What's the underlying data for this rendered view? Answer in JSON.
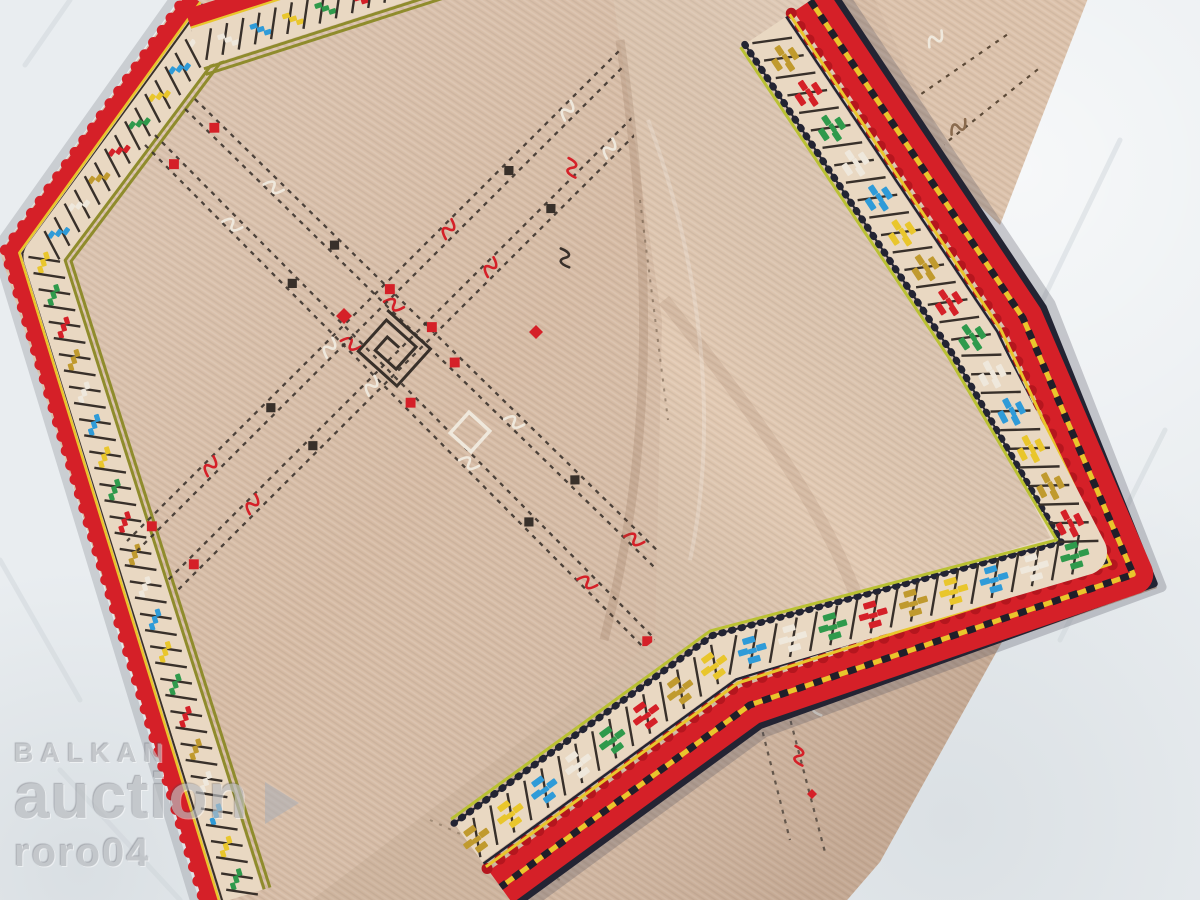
{
  "photo": {
    "subject": "hand-embroidered folk kerchief with ornamental cross-stitch borders, one corner folded over, lying on white cloth",
    "weave": "beige woven wool with fine diagonal ribs"
  },
  "watermark": {
    "brand_top": "BALKAN",
    "brand_main": "auction",
    "logo": "play-triangle-icon",
    "username": "roro04"
  },
  "palette": {
    "background_cloth": "#e9edf0",
    "cloth_shadow": "#ccd3d8",
    "cloth_highlight": "#f7f9fa",
    "kerchief_front": "#d6bba4",
    "kerchief_front_light": "#e0c8b1",
    "kerchief_back": "#e2c9b2",
    "back_layer": "#dcc2ab",
    "border_red": "#d52028",
    "border_red_dark": "#b5161e",
    "hem_navy": "#232433",
    "yellow": "#e9c62c",
    "gold": "#c09a2e",
    "olive": "#8f8c2c",
    "yellow_green": "#b9c132",
    "green": "#2f9a4c",
    "blue": "#2f9bd8",
    "silver": "#efe8dc",
    "cream_band": "#e9d8c2",
    "stitch_dark": "#38302a",
    "stitch_brown": "#5c4a38",
    "watermark_gray": "#b9bcc0",
    "front_motif_cycle": [
      "#efe8dc",
      "#2f9bd8",
      "#e9c62c",
      "#2f9a4c",
      "#d52028",
      "#c09a2e"
    ],
    "flap_motif_cycle": [
      "#c09a2e",
      "#d52028",
      "#2f9a4c",
      "#efe8dc",
      "#2f9bd8",
      "#e9c62c"
    ],
    "track_motif_cycle": [
      "red-diamond",
      "silver-squiggle",
      "dark-diamond",
      "red-squiggle"
    ]
  }
}
